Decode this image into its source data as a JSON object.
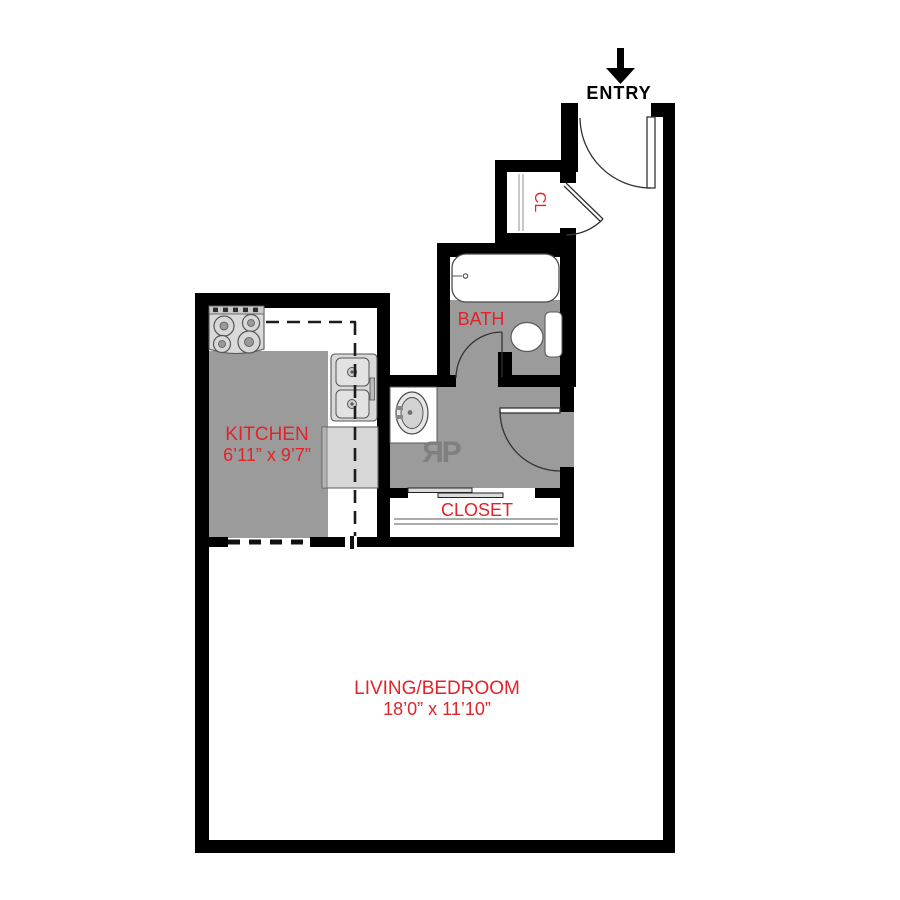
{
  "title": "Studio apartment floor plan",
  "colors": {
    "wall": "#000000",
    "floor_gray": "#9b9b9b",
    "fixture_gray": "#d9d9d9",
    "label_red": "#e2232a",
    "logo_gray": "#7f7f7f"
  },
  "labels": {
    "entry": "ENTRY",
    "cl": "CL",
    "bath": "BATH",
    "closet": "CLOSET"
  },
  "rooms": {
    "kitchen": {
      "name": "KITCHEN",
      "dimensions": "6’11” x 9’7”"
    },
    "living": {
      "name": "LIVING/BEDROOM",
      "dimensions": "18’0” x 11’10”"
    }
  },
  "logo": {
    "text": "ЯP"
  }
}
